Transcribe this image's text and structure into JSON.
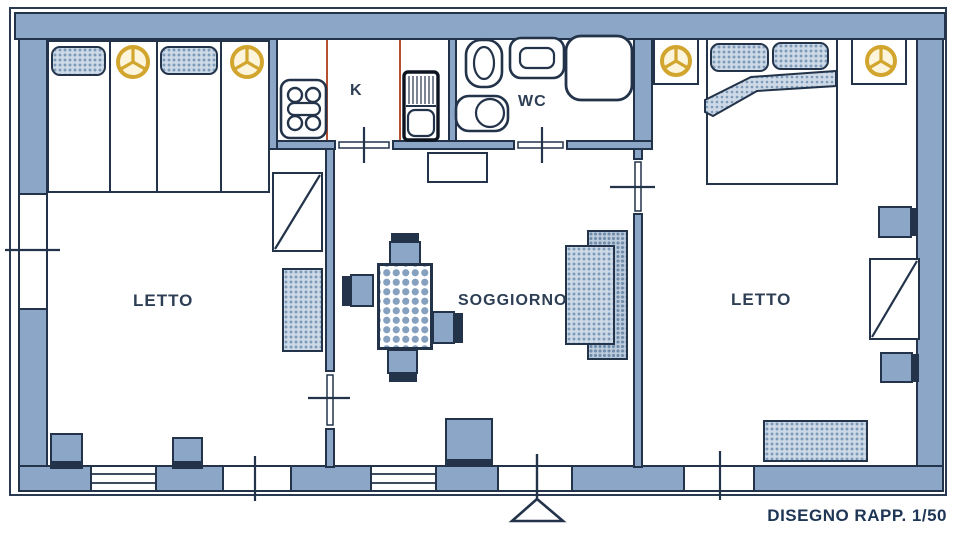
{
  "drawing": {
    "caption": "DISEGNO RAPP. 1/50",
    "scale": "1/50",
    "type": "apartment floor plan"
  },
  "rooms": {
    "bedroom_left": {
      "label": "LETTO"
    },
    "kitchen": {
      "label": "K"
    },
    "bathroom": {
      "label": "WC"
    },
    "living_room": {
      "label": "SOGGIORNO"
    },
    "bedroom_right": {
      "label": "LETTO"
    }
  },
  "symbols": {
    "lamp": "yellow circle with three spokes (light point)",
    "stove": "4-burner cooktop",
    "fridge": "refrigerator with hatched top",
    "bathroom_fixtures": [
      "bidet",
      "sink",
      "shower",
      "toilet"
    ],
    "entrance": "triangle marker at bottom wall",
    "stipple_areas": [
      "pillows",
      "rugs",
      "sofa",
      "blanket"
    ],
    "checker_area": "dining table"
  },
  "colors": {
    "wall": "#8ba6c6",
    "outline": "#22334a",
    "lamp_yellow": "#d2a52e",
    "kitchen_counter_red": "#b5502f",
    "label_text": "#2e3f55"
  }
}
